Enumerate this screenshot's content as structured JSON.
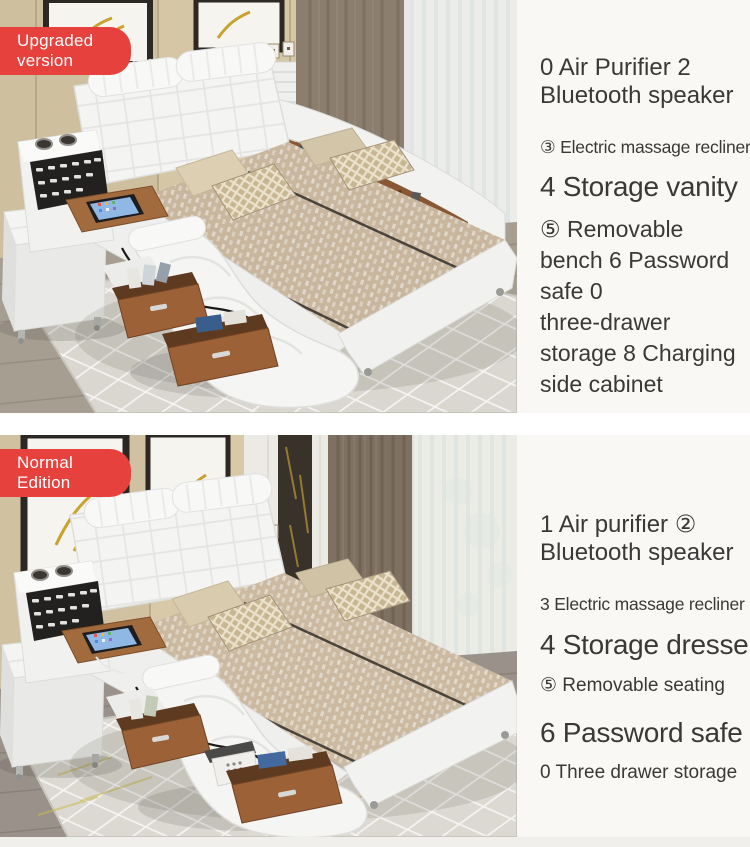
{
  "sections": [
    {
      "variant": "upgraded",
      "badge_lines": [
        "Upgraded",
        "version"
      ],
      "features": [
        {
          "text": "0 Air Purifier 2\nBluetooth speaker"
        },
        {
          "text": "③ Electric massage recliner"
        },
        {
          "text": "4 Storage vanity"
        },
        {
          "text": "⑤ Removable\nbench 6 Password\nsafe 0\nthree-drawer\nstorage 8 Charging\nside cabinet"
        }
      ]
    },
    {
      "variant": "normal",
      "badge_lines": [
        "Normal",
        "Edition"
      ],
      "features": [
        {
          "text": "1 Air purifier ②\nBluetooth speaker"
        },
        {
          "text": "3 Electric massage recliner"
        },
        {
          "text": "4 Storage dresser"
        },
        {
          "text": "⑤ Removable seating"
        },
        {
          "text": "6 Password safe"
        },
        {
          "text": "0 Three drawer storage"
        }
      ]
    }
  ],
  "colors": {
    "badge_red": "#e6413d",
    "text_dark": "#3a3938",
    "panel_bg": "#faf8f5"
  }
}
